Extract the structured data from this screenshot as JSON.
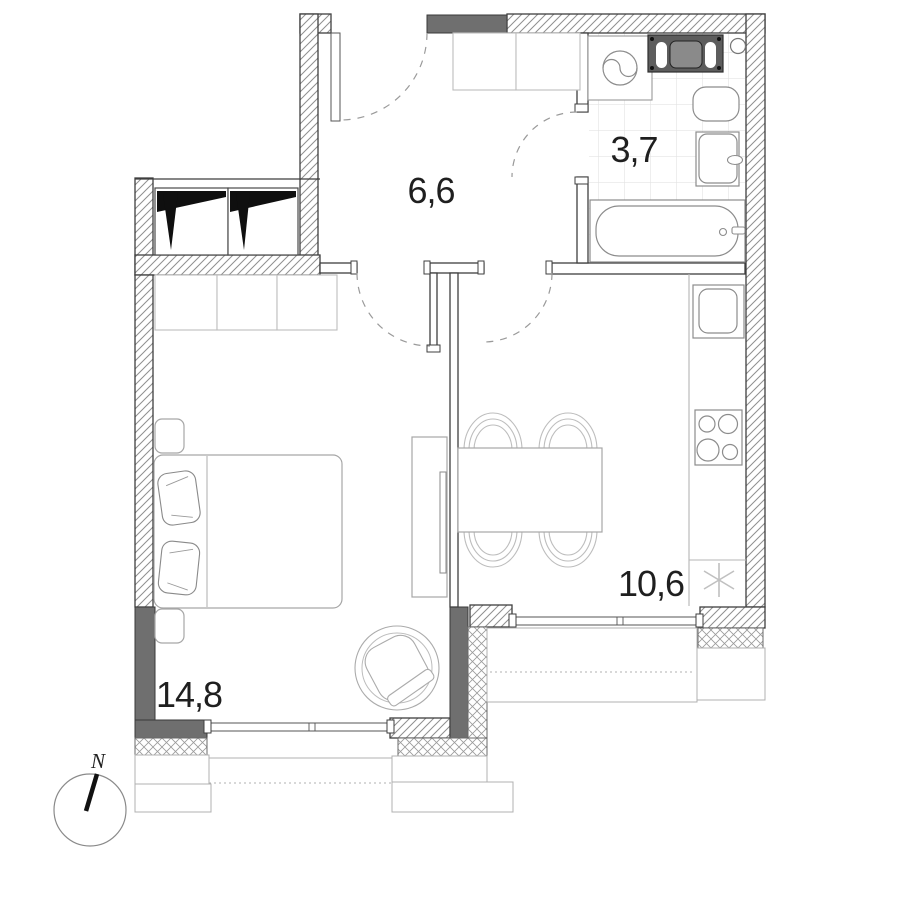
{
  "title": "Apartment floor plan",
  "rooms": [
    {
      "name": "hallway",
      "area_label": "6,6"
    },
    {
      "name": "bathroom",
      "area_label": "3,7"
    },
    {
      "name": "kitchen-living-room",
      "area_label": "10,6"
    },
    {
      "name": "bedroom",
      "area_label": "14,8"
    }
  ],
  "compass": {
    "north_label": "N"
  },
  "colors": {
    "wall_outline": "#3f3f3f",
    "wall_solid": "#6f6f6f",
    "hatch_line": "#8f8f8f",
    "furniture_line": "#a6a6a6",
    "fixture_line": "#8c8c8c",
    "label_text": "#1f1f1f",
    "tile_line": "#e3e3e3",
    "appliance_dark": "#5d5d5d"
  }
}
